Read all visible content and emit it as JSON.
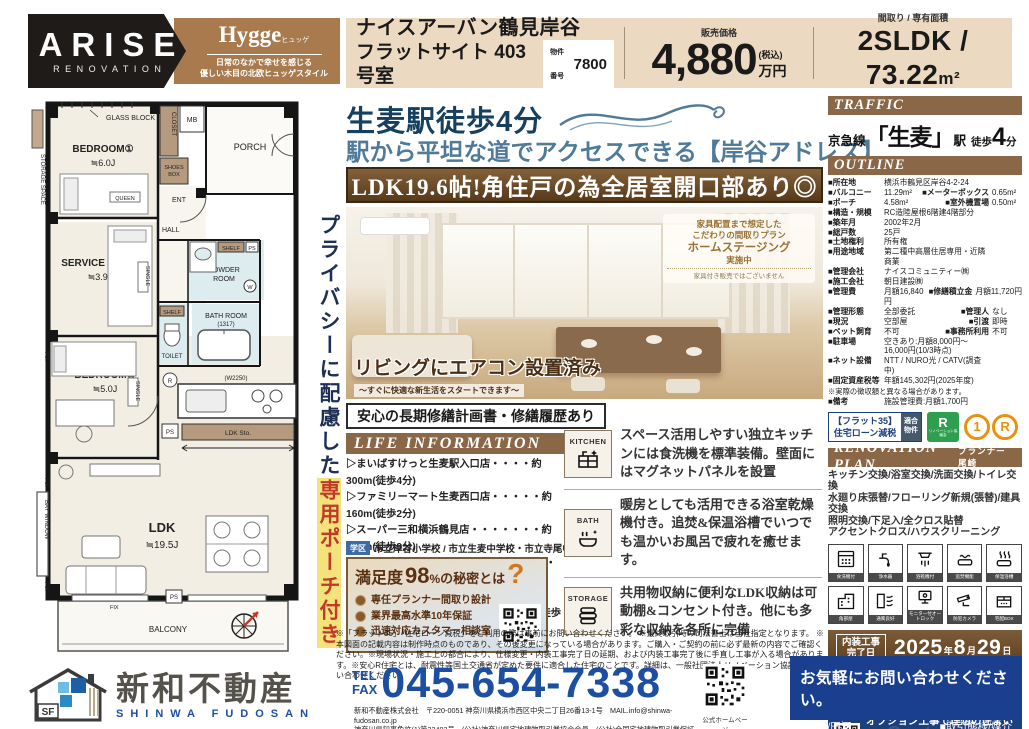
{
  "colors": {
    "accent_brown": "#8a6746",
    "banner_brown": "#5c3f1f",
    "navy": "#16405f",
    "steel_blue": "#4f7a99",
    "royal_blue": "#1c4fa1",
    "contact_navy": "#1a3f8f",
    "beige": "#ecd9c1",
    "red": "#c0392b",
    "highlight_yellow": "#f5e27a"
  },
  "header": {
    "brand": "ARISE",
    "brand_sub": "RENOVATION",
    "style_title": "Hygge",
    "style_ruby": "ヒュッゲ",
    "style_tag1": "日常のなかで幸せを感じる",
    "style_tag2": "優しい木目の北欧ヒュッゲスタイル",
    "name_l1": "ナイスアーバン鶴見岸谷",
    "name_l2": "フラットサイト 403号室",
    "bukken_label": "物件番号",
    "bukken_no": "7800",
    "price_label": "販売価格",
    "price_value": "4,880",
    "price_tax": "(税込)",
    "price_unit": "万円",
    "layout_label": "間取り / 専有面積",
    "layout_value": "2SLDK / 73.22",
    "layout_unit": "m²"
  },
  "hero": {
    "catch1": "生麦駅徒歩4分",
    "catch2": "駅から平坦な道でアクセスできる【岸谷アドレス】",
    "banner": "LDK19.6帖!角住戸の為全居室開口部あり◎",
    "badge_l1": "家具配置まで想定した",
    "badge_l2": "こだわりの間取りプラン",
    "badge_l3": "ホームステージング",
    "badge_l4": "実施中",
    "badge_note": "家具付き販売ではございません",
    "photo_caption": "リビングにエアコン設置済み",
    "photo_caption_sub": "〜すぐに快適な新生活をスタートできます〜"
  },
  "repair_title": "安心の長期修繕計画書・修繕履歴あり",
  "life": {
    "title": "LIFE INFORMATION",
    "items": [
      "▷まいばすけっと生麦駅入口店・・・・約300m(徒歩4分)",
      "▷ファミリーマート生麦西口店・・・・・約160m(徒歩2分)",
      "▷スーパー三和横浜鶴見店・・・・・・・約650m(徒歩9分)",
      "▷クリエイトSD鶴見生麦店・・・・・・・・約800m(徒歩10分)",
      "▷鶴見花月園公園・・・・・・・・・・・・・・約700m(徒歩9分)"
    ],
    "school_badge": "学区",
    "school_text": "市立岸谷小学校 / 市立生麦中学校・市立寺尾中学校"
  },
  "satisfaction": {
    "t1": "満足度",
    "t2": "98",
    "t2u": "%",
    "t3": "の秘密とは",
    "q": "?",
    "items": [
      "専任プランナー間取り設計",
      "業界最高水準10年保証",
      "迅速対応カスタマー相談室"
    ]
  },
  "features": [
    {
      "tag": "KITCHEN",
      "text": "スペース活用しやすい独立キッチンには食洗機を標準装備。壁面にはマグネットパネルを設置"
    },
    {
      "tag": "BATH",
      "text": "暖房としても活用できる浴室乾燥機付き。追焚&保温浴槽でいつでも温かいお風呂で疲れを癒せます。"
    },
    {
      "tag": "STORAGE",
      "text": "共用物収納に便利なLDK収納は可動棚&コンセント付き。他にも多彩な収納を各所に完備"
    }
  ],
  "disclaimer": "※「フラット35」「住宅ローン減税」をご利用の際は事前にお問い合わせください。 ※最終取引時の司法書士は当社指定となります。 ※本図面の記載内容は制作時点のものであり、その後変更になっている場合があります。ご購入・ご契約の前に必ず最新の内容でご確認ください。※現場状況・施工上の都合により、仕様変更・内装工事完了日の延期、および内装工事完了後に手直し工事が入る場合があります。※安心R住宅とは、耐震性等国土交通省が定めた要件に適合した住宅のことです。詳細は、一般社団法人リノベーション協議会にお問い合わせください。",
  "traffic": {
    "title": "TRAFFIC",
    "line_pre": "京急線",
    "station": "「生麦」",
    "eki": "駅",
    "walk": "徒歩",
    "min": "4",
    "fun": "分"
  },
  "outline": {
    "title": "OUTLINE",
    "rows": [
      {
        "l": "■所在地",
        "v": "横浜市鶴見区岸谷4-2-24",
        "l2": "",
        "v2": ""
      },
      {
        "l": "■バルコニー",
        "v": "11.29m²",
        "l2": "■メーターボックス",
        "v2": "0.65m²"
      },
      {
        "l": "■ポーチ",
        "v": "4.58m²",
        "l2": "■室外機置場",
        "v2": "0.50m²"
      },
      {
        "l": "■構造・規模",
        "v": "RC造陸屋根6階建4階部分",
        "l2": "",
        "v2": ""
      },
      {
        "l": "■築年月",
        "v": "2002年2月",
        "l2": "",
        "v2": ""
      },
      {
        "l": "■総戸数",
        "v": "25戸",
        "l2": "",
        "v2": ""
      },
      {
        "l": "■土地権利",
        "v": "所有権",
        "l2": "",
        "v2": ""
      },
      {
        "l": "■用途地域",
        "v": "第二種中高層住居専用・近隣商業",
        "l2": "",
        "v2": ""
      },
      {
        "l": "■管理会社",
        "v": "ナイスコミュニティー㈱",
        "l2": "",
        "v2": ""
      },
      {
        "l": "■施工会社",
        "v": "朝日建設㈱",
        "l2": "",
        "v2": ""
      },
      {
        "l": "■管理費",
        "v": "月額16,840円",
        "l2": "■修繕積立金",
        "v2": "月額11,720円"
      },
      {
        "l": "■管理形態",
        "v": "全部委託",
        "l2": "■管理人",
        "v2": "なし"
      },
      {
        "l": "■現況",
        "v": "空部屋",
        "l2": "■引渡",
        "v2": "即時"
      },
      {
        "l": "■ペット飼育",
        "v": "不可",
        "l2": "■事務所利用",
        "v2": "不可"
      },
      {
        "l": "■駐車場",
        "v": "空きあり:月額8,000円〜16,000円(10/3時点)",
        "l2": "",
        "v2": ""
      },
      {
        "l": "■ネット設備",
        "v": "NTT / NURO光 / CATV(調査中)",
        "l2": "",
        "v2": ""
      },
      {
        "l": "■固定資産税等",
        "v": "年額145,302円(2025年度)",
        "l2": "",
        "v2": ""
      }
    ],
    "note": "※実際の徴収額と異なる場合があります。",
    "bikou_l": "■備考",
    "bikou_v": "施設管理費:月額1,700円"
  },
  "badges": {
    "flat35_l1": "【フラット35】",
    "flat35_l2": "住宅ローン減税",
    "flat35_tab1": "適合",
    "flat35_tab2": "物件",
    "r_mark": "R",
    "r_caption": "リノベーション協議会",
    "circle1": "1",
    "circle2": "R"
  },
  "reno": {
    "title": "RENOVATION PLAN",
    "planner": "プランナー 尾崎",
    "lines": [
      "キッチン交換/浴室交換/洗面交換/トイレ交換",
      "水廻り床張替/フローリング新規(張替)/建具交換",
      "照明交換/下足入/全クロス貼替",
      "アクセントクロス/ハウスクリーニング"
    ],
    "equipment": [
      "食洗機付",
      "浄水器",
      "浴乾機付",
      "追焚機能",
      "保温浴槽",
      "角部屋",
      "通風良好",
      "モニター付オートロック",
      "防犯カメラ",
      "宅配BOX"
    ]
  },
  "naiso": {
    "l1": "内装工事",
    "l2": "完了日",
    "y": "2025",
    "yu": "年",
    "m": "8",
    "mu": "月",
    "d": "29",
    "du": "日"
  },
  "vr": {
    "t1": "360°VR内見",
    "t2": "パノラマview"
  },
  "custom": {
    "t1": "オプション工事で理想の住まいへ",
    "t2a": "アライズ",
    "t2b": "カスタムオーダー",
    "watermark": "Custom Order"
  },
  "fp": {
    "storage_space": "STORAGE SPACE",
    "glass_block": "GLASS BLOCK",
    "bedroom1": "BEDROOM①",
    "bedroom1_size": "≒6.0J",
    "queen": "QUEEN",
    "closet": "CLOSET",
    "mb": "MB",
    "porch": "PORCH",
    "shoes1": "SHOES",
    "shoes2": "BOX",
    "ent": "ENT",
    "hall": "HALL",
    "service": "SERVICE ROOM",
    "service_size": "≒3.9J",
    "single": "SINGLE",
    "powder1": "POWDER",
    "powder2": "ROOM",
    "shelf": "SHELF",
    "ps": "PS",
    "w": "W",
    "bath1": "BATH ROOM",
    "bath2": "(1317)",
    "toilet": "TOILET",
    "r": "R",
    "bedroom2": "BEDROOM②",
    "bedroom2_size": "≒5.0J",
    "w2250": "(W2250)",
    "ldk_sto": "LDK Sto.",
    "ldk": "LDK",
    "ldk_size": "≒19.5J",
    "bay": "BAY WINDOW",
    "fix": "FIX",
    "balcony": "BALCONY",
    "privacy1": "プライバシーに配慮した",
    "privacy2": "専用ポーチ付き"
  },
  "footer": {
    "sf": "SF",
    "company": "新和不動産",
    "company_en": "SHINWA FUDOSAN",
    "tel_label": "TEL",
    "fax_label": "FAX",
    "phone": "045-654-7338",
    "addr1": "新和不動産株式会社　〒220-0051 神奈川県横浜市西区中央二丁目26番13-1号　MAIL.info@shinwa-fudosan.co.jp",
    "addr2": "神奈川県知事免許(1)第32403号　(公社)神奈川県宅地建物取引業協会会員　(公社)全国宅地建物取引業保証協会会員",
    "qr_label": "公式ホームページ",
    "contact_title": "お気軽にお問い合わせください。",
    "contact_staff": "■担当/田河",
    "contact_type": "■取引態様/媒介"
  }
}
